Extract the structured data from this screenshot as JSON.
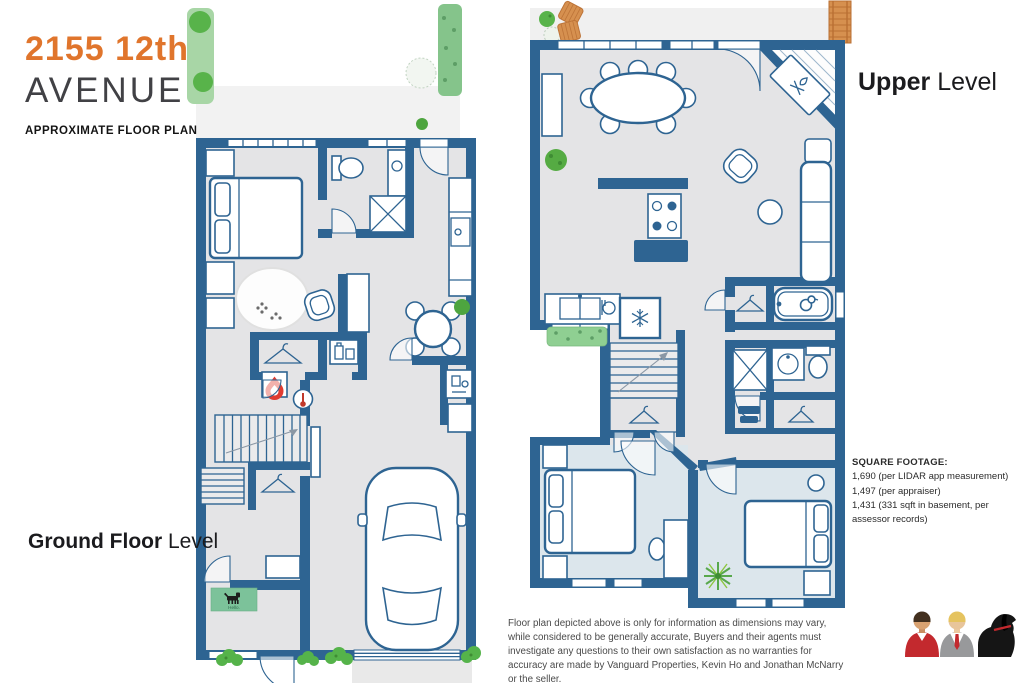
{
  "header": {
    "address_line1": "2155 12th",
    "address_line2": "AVENUE",
    "subtitle": "APPROXIMATE FLOOR PLAN"
  },
  "floor_labels": {
    "ground": {
      "strong": "Ground Floor",
      "light": "Level"
    },
    "upper": {
      "strong": "Upper",
      "light": "Level"
    }
  },
  "square_footage": {
    "heading": "SQUARE FOOTAGE:",
    "line1": "1,690 (per LIDAR app measurement)",
    "line2": "1,497 (per appraiser)",
    "line3": "1,431 (331 sqft in basement, per assessor records)"
  },
  "disclaimer": "Floor plan depicted above is only for information as dimensions may vary, while considered to be generally accurate, Buyers and their agents must investigate any questions to their own satisfaction as no warranties for accuracy are made by Vanguard Properties, Kevin Ho and Jonathan McNarry or the seller.",
  "doormat": {
    "text": "Hello."
  },
  "colors": {
    "wall_blue": "#2e6492",
    "floor_gray": "#e4e4e6",
    "bedroom_blue": "#dce6ec",
    "title_orange": "#e0752c",
    "plant_green": "#55ab43",
    "hedge_green": "#9ed3a0",
    "mat_green": "#7cc29a",
    "wood_orange": "#d6904f",
    "flame_red": "#e03c31",
    "avatar_red": "#c3292e",
    "dog_black": "#151515"
  },
  "icons": {
    "hanger-icon": "clothes hanger (closets)",
    "flame-icon": "red flame in box (furnace)",
    "thermostat-icon": "thermometer in circle",
    "laundry-icon": "detergent bottles in box",
    "utility-icon": "utility/water-heater box",
    "paw-prints-icon": "paw prints on pet rug",
    "snowflake-icon": "snowflake (refrigerator)",
    "dish-icon": "dishes (dishwasher)",
    "duck-icon": "rubber duck (bathtub)",
    "campfire-icon": "campfire (fireplace)",
    "towels-icon": "stacked towels (linen closet)",
    "dog-mat-icon": "dog on welcome mat",
    "car-icon": "car top view (garage)",
    "ladder-icon": "roof ladder",
    "deck-cushion-icon": "outdoor cushions",
    "bush-icon": "shrubs and hedges",
    "agent-red-shirt-icon": "man in red shirt",
    "agent-gray-suit-icon": "man in gray suit with red tie",
    "black-dog-icon": "black labrador with red collar"
  }
}
